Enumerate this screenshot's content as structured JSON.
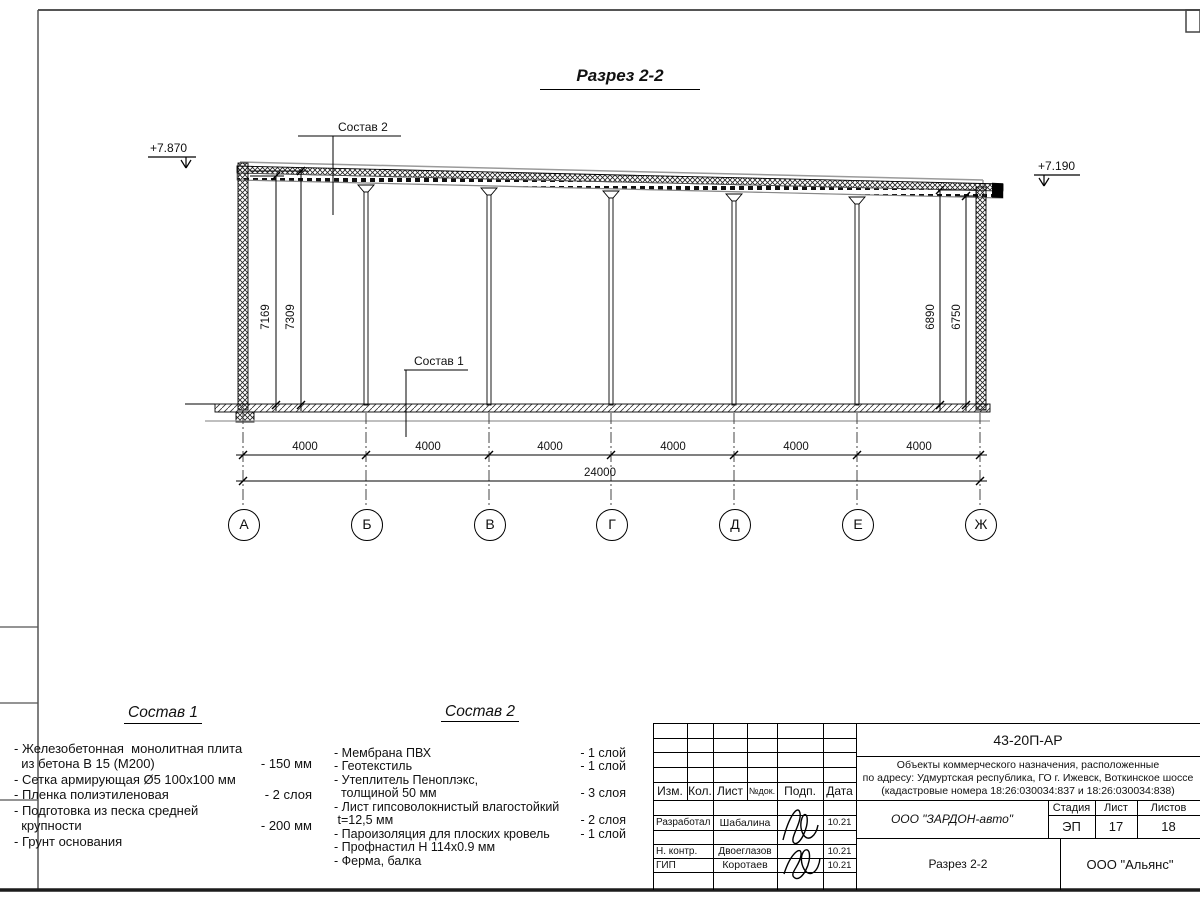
{
  "drawing": {
    "title": "Разрез 2-2",
    "elevations": {
      "left": "+7.870",
      "right": "+7.190"
    },
    "callouts": {
      "roof": "Состав 2",
      "floor": "Состав 1"
    },
    "dimensions": {
      "left_inner": "7169",
      "left_outer": "7309",
      "right_outer": "6890",
      "right_inner": "6750",
      "bays": [
        "4000",
        "4000",
        "4000",
        "4000",
        "4000",
        "4000"
      ],
      "total": "24000"
    },
    "grid_axes": [
      "А",
      "Б",
      "В",
      "Г",
      "Д",
      "Е",
      "Ж"
    ]
  },
  "legend_floor": {
    "title": "Состав 1",
    "items": [
      {
        "name": "- Железобетонная  монолитная плита\n  из бетона В 15 (М200)",
        "value": "- 150 мм"
      },
      {
        "name": "- Сетка армирующая Ø5 100х100 мм",
        "value": ""
      },
      {
        "name": "- Пленка полиэтиленовая",
        "value": "-  2 слоя"
      },
      {
        "name": "- Подготовка из песка средней\n  крупности",
        "value": "- 200 мм"
      },
      {
        "name": "- Грунт основания",
        "value": ""
      }
    ]
  },
  "legend_roof": {
    "title": "Состав 2",
    "items": [
      {
        "name": "- Мембрана ПВХ",
        "value": "- 1 слой"
      },
      {
        "name": "- Геотекстиль",
        "value": "- 1 слой"
      },
      {
        "name": "- Утеплитель Пеноплэкс,\n  толщиной 50 мм",
        "value": "- 3 слоя"
      },
      {
        "name": "- Лист гипсоволокнистый влагостойкий\n t=12,5 мм",
        "value": "- 2 слоя"
      },
      {
        "name": "- Пароизоляция для плоских кровель",
        "value": "- 1 слой"
      },
      {
        "name": "- Профнастил Н 114х0.9 мм",
        "value": ""
      },
      {
        "name": "- Ферма, балка",
        "value": ""
      }
    ]
  },
  "titleblock": {
    "doc_number": "43-20П-АР",
    "project_line1": "Объекты коммерческого назначения, расположенные",
    "project_line2": "по адресу: Удмуртская республика, ГО г. Ижевск, Воткинское шоссе",
    "project_line3": "(кадастровые номера 18:26:030034:837 и 18:26:030034:838)",
    "cols": {
      "izm": "Изм.",
      "kol": "Кол.",
      "list": "Лист",
      "ndok": "№док.",
      "podp": "Подп.",
      "data": "Дата"
    },
    "rows": [
      {
        "role": "Разработал",
        "name": "Шабалина",
        "date": "10.21"
      },
      {
        "role": "Н. контр.",
        "name": "Двоеглазов",
        "date": "10.21"
      },
      {
        "role": "ГИП",
        "name": "Коротаев",
        "date": "10.21"
      }
    ],
    "company": "ООО \"ЗАРДОН-авто\"",
    "stage_label": "Стадия",
    "sheet_label": "Лист",
    "sheets_label": "Листов",
    "stage": "ЭП",
    "sheet_num": "17",
    "sheets_total": "18",
    "drawing_name": "Разрез 2-2",
    "contractor": "ООО \"Альянс\""
  }
}
